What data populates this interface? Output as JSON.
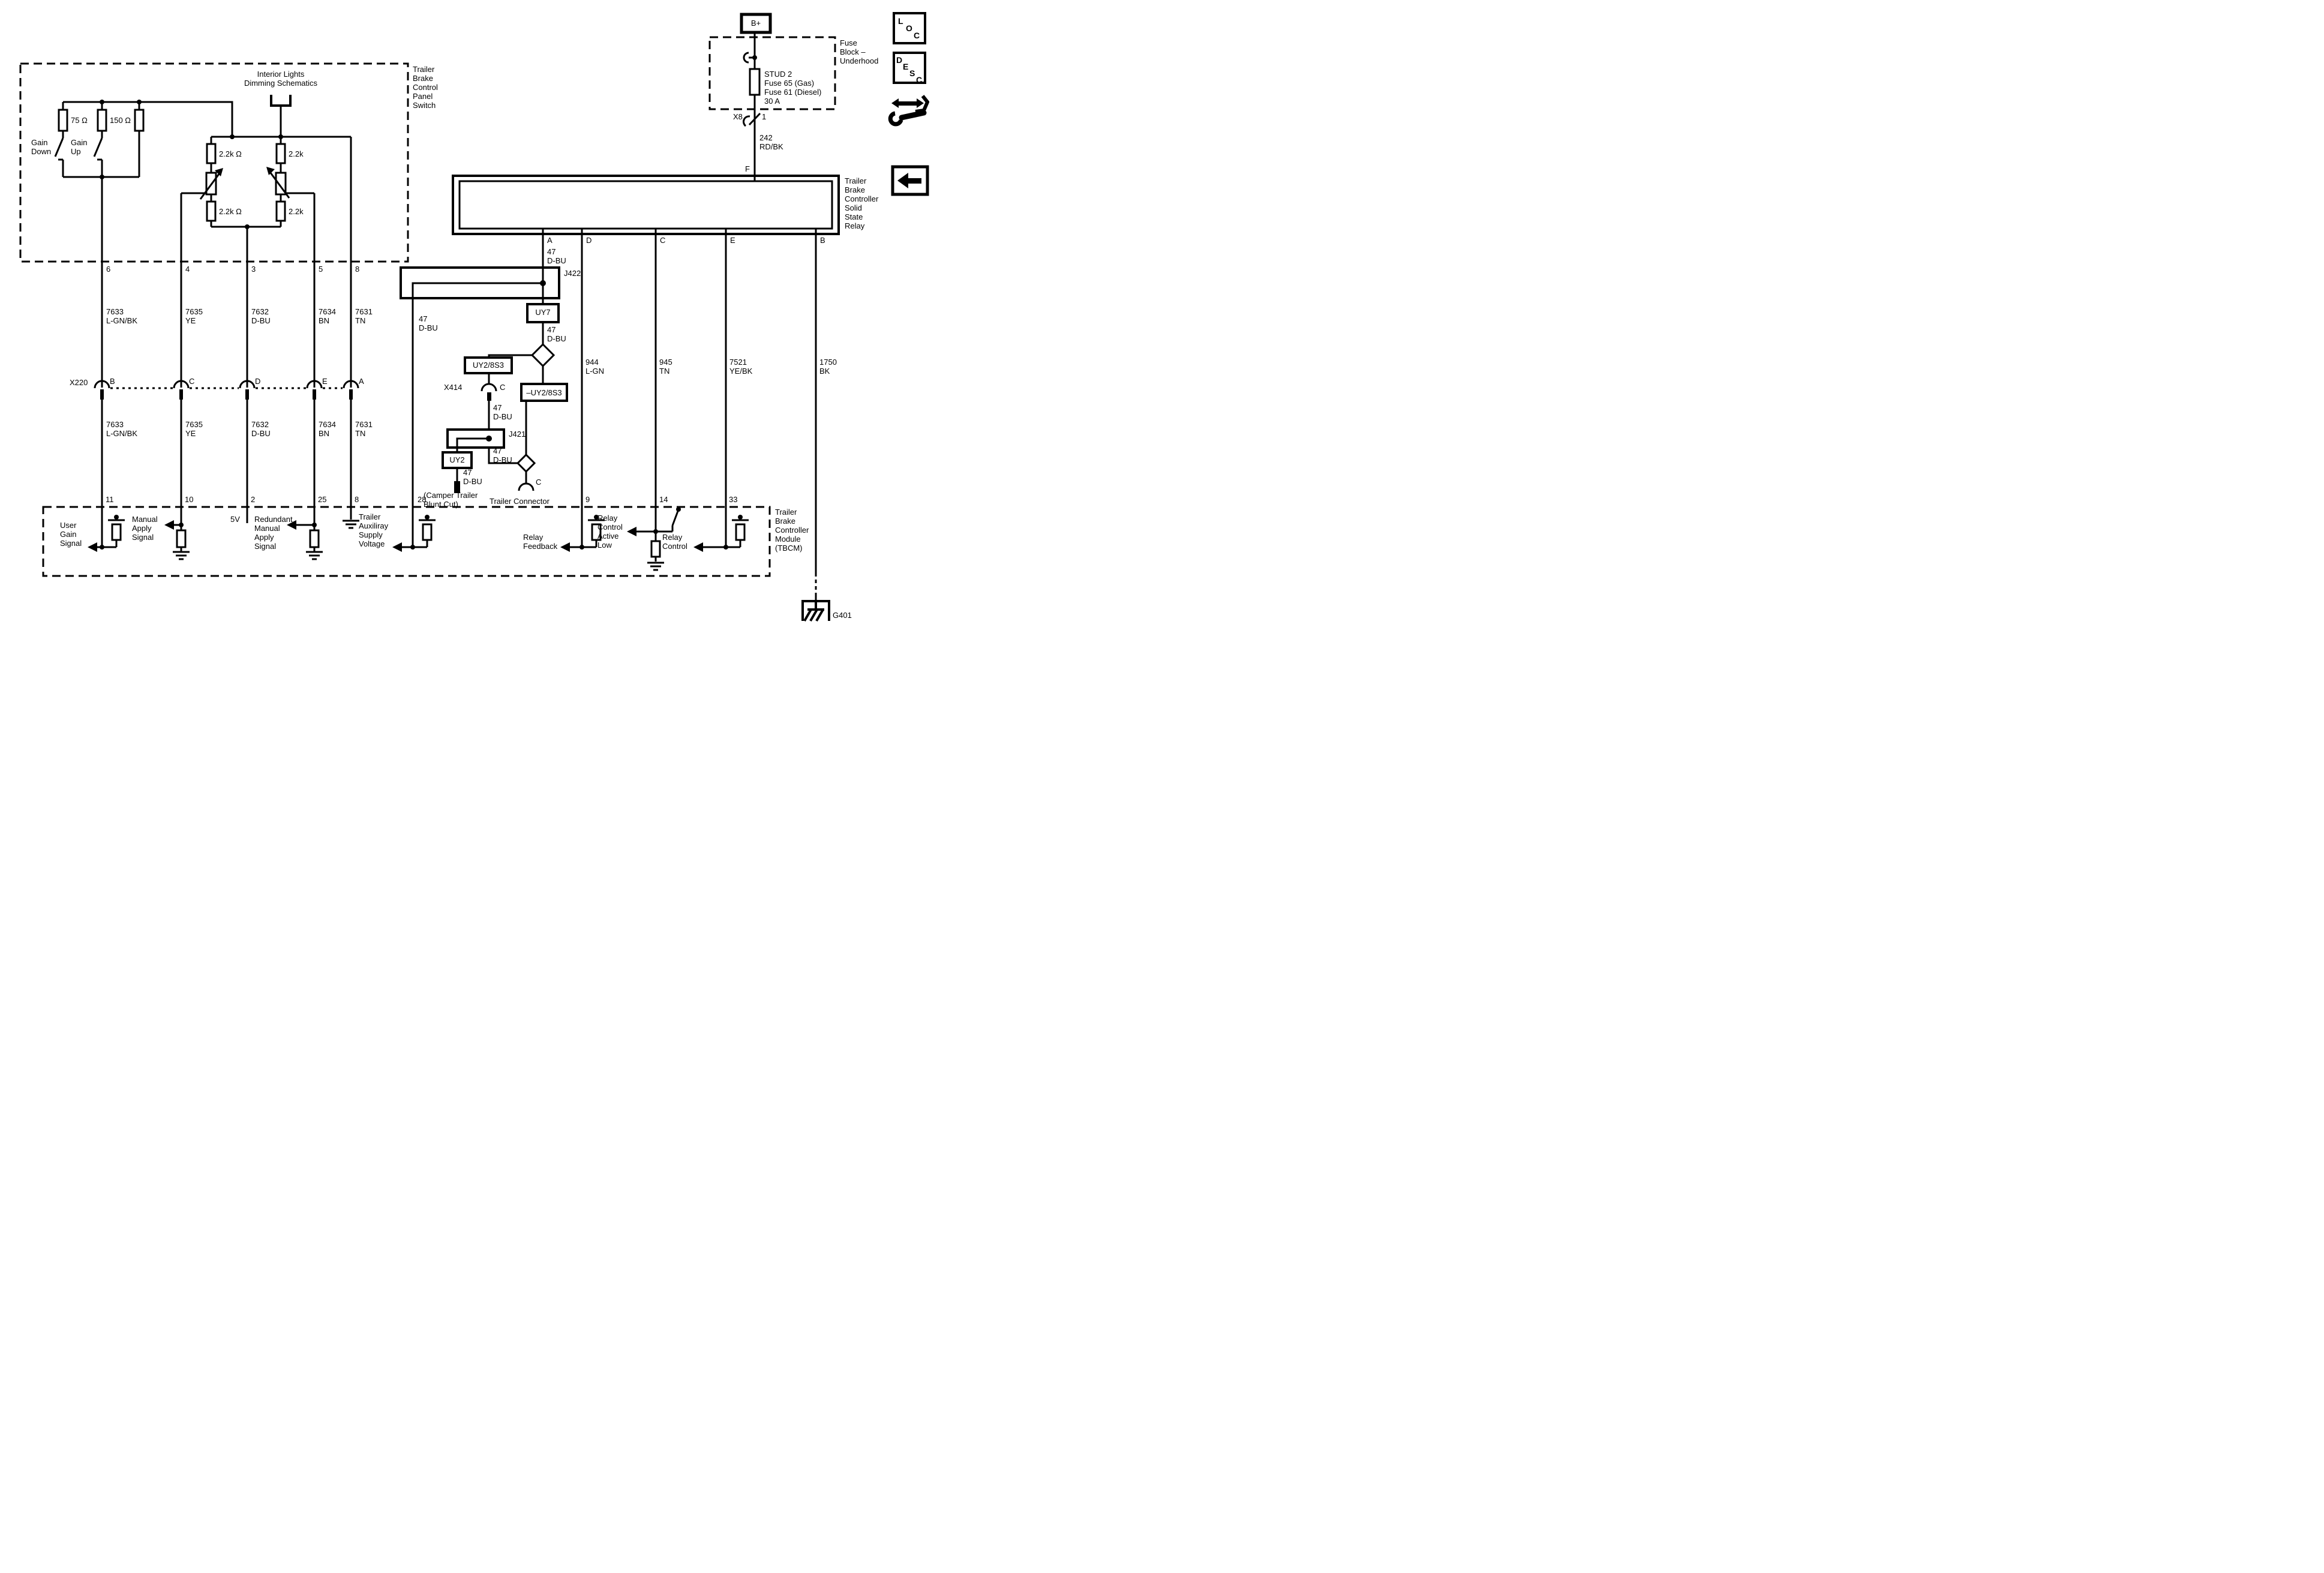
{
  "panel_switch": {
    "title": "Interior Lights\nDimming Schematics",
    "box_label": "Trailer\nBrake\nControl\nPanel\nSwitch",
    "gain_down": "Gain\nDown",
    "gain_up": "Gain\nUp",
    "r_75": "75 Ω",
    "r_150": "150 Ω",
    "r_22k_ohm": "2.2k Ω",
    "r_22k": "2.2k"
  },
  "top_pins": [
    "6",
    "4",
    "3",
    "5",
    "8"
  ],
  "x220": {
    "label": "X220",
    "pins": [
      "B",
      "C",
      "D",
      "E",
      "A"
    ]
  },
  "wires": {
    "w7633": "7633\nL-GN/BK",
    "w7635": "7635\nYE",
    "w7632": "7632\nD-BU",
    "w7634": "7634\nBN",
    "w7631": "7631\nTN",
    "w47": "47\nD-BU",
    "w242": "242\nRD/BK",
    "w944": "944\nL-GN",
    "w945": "945\nTN",
    "w7521": "7521\nYE/BK",
    "w1750": "1750\nBK"
  },
  "fuse_block": {
    "bplus": "B+",
    "label": "Fuse\nBlock –\nUnderhood",
    "fuse": "STUD 2\nFuse 65 (Gas)\nFuse 61 (Diesel)\n30 A",
    "x8": "X8",
    "x8_pin": "1"
  },
  "relay": {
    "label": "Trailer\nBrake\nController\nSolid\nState\nRelay",
    "pin_f": "F",
    "pins": [
      "A",
      "D",
      "C",
      "E",
      "B"
    ]
  },
  "splices": {
    "j422": "J422",
    "uy7": "UY7",
    "uy2_8s3": "UY2/8S3",
    "x414": "X414",
    "x414_pin": "C",
    "minus_uy2_8s3": "–UY2/8S3",
    "j421": "J421",
    "uy2": "UY2",
    "camper": "(Camper Trailer\nBlunt Cut)",
    "trailer_connector": "Trailer Connector",
    "trailer_connector_pin": "C"
  },
  "tbcm": {
    "label": "Trailer\nBrake\nController\nModule\n(TBCM)",
    "pins": [
      "11",
      "10",
      "2",
      "25",
      "8",
      "28",
      "9",
      "14",
      "33"
    ],
    "signals": {
      "user_gain": "User\nGain\nSignal",
      "manual_apply": "Manual\nApply\nSignal",
      "five_v": "5V",
      "redundant": "Redundant\nManual\nApply\nSignal",
      "trailer_aux": "Trailer\nAuxiliray\nSupply\nVoltage",
      "relay_feedback": "Relay\nFeedback",
      "relay_control_active_low": "Relay\nControl\nActive\nLow",
      "relay_control": "Relay\nControl"
    }
  },
  "ground": {
    "g401": "G401"
  },
  "icons": {
    "loc": [
      "L",
      "O",
      "C"
    ],
    "desc": [
      "D",
      "E",
      "S",
      "C"
    ]
  }
}
